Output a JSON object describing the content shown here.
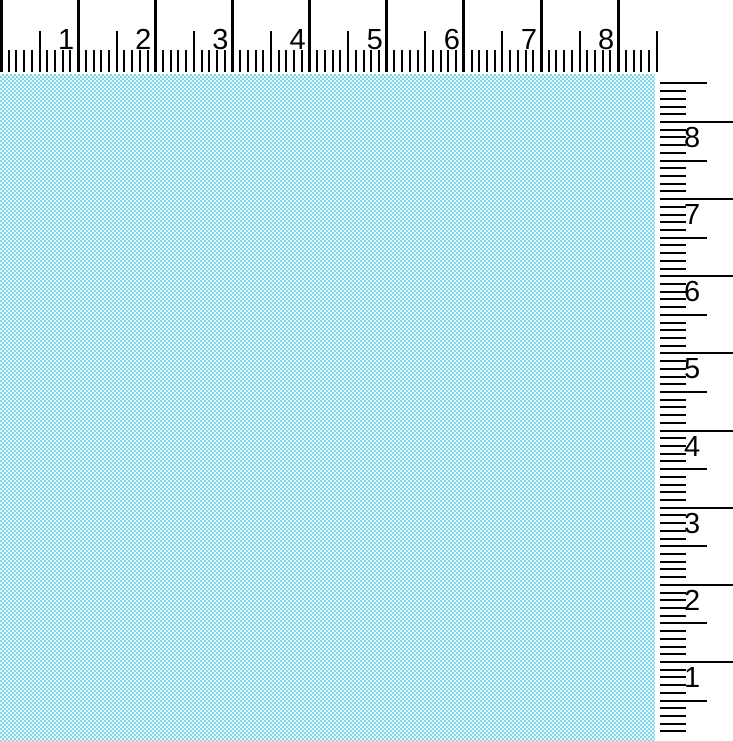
{
  "scene": {
    "description": "Light aqua woven fabric swatch photographed with inch rulers along the top and right edges"
  },
  "fabric": {
    "color_light": "#e9f7fb",
    "color_dark": "#7ed7e9"
  },
  "top_ruler": {
    "labels": [
      "1",
      "2",
      "3",
      "4",
      "5",
      "6",
      "7",
      "8"
    ],
    "origin_px": 1,
    "inch_spacing_px": 77.15,
    "max_inches": 8.5,
    "subdivisions_per_inch": 10,
    "tick_color": "#000000"
  },
  "right_ruler": {
    "labels": [
      "8",
      "7",
      "6",
      "5",
      "4",
      "3",
      "2",
      "1"
    ],
    "top_inch_value": 8,
    "top_inch_y_px": 122,
    "inch_spacing_px": 77.15,
    "max_inches": 8.5,
    "min_inches": 0.1,
    "subdivisions_per_inch": 10,
    "tick_color": "#000000"
  }
}
